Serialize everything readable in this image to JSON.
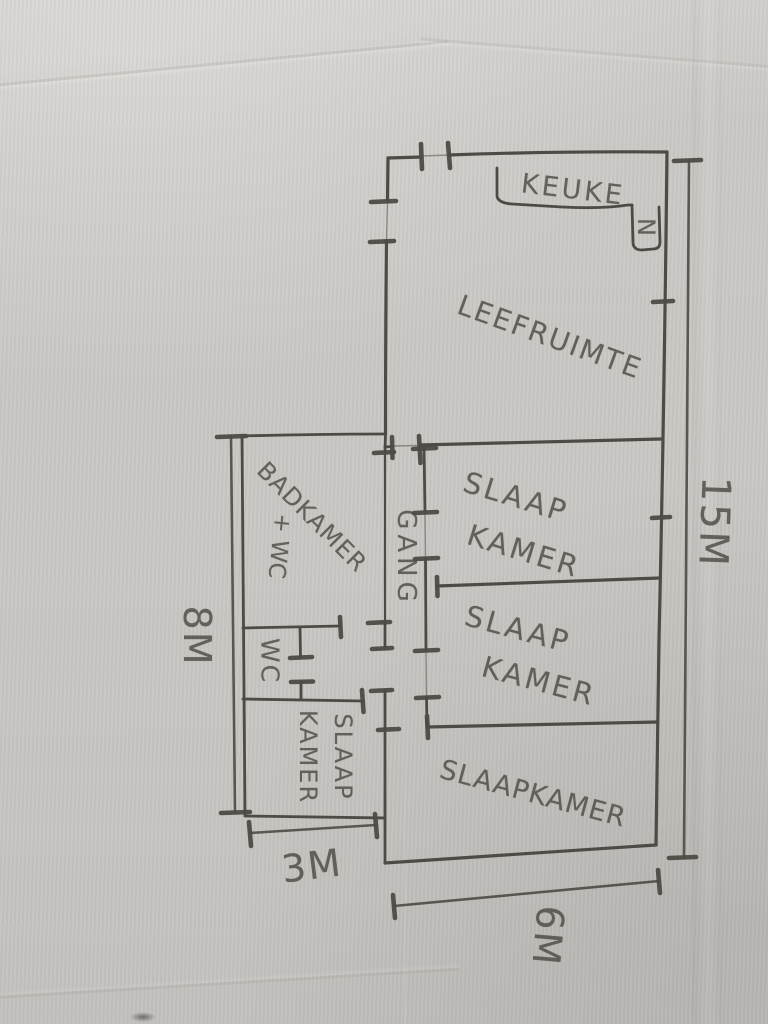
{
  "colors": {
    "pencil": "#4e4a45",
    "paper": "#c9c7c3"
  },
  "rooms": {
    "keuken": {
      "label_main": "KEUKE",
      "label_n": "N"
    },
    "leefruimte": {
      "label": "LEEFRUIMTE"
    },
    "slaapkamer_1": {
      "line1": "SLAAP",
      "line2": "KAMER"
    },
    "slaapkamer_2": {
      "line1": "SLAAP",
      "line2": "KAMER"
    },
    "slaapkamer_groot": {
      "label": "SLAAPKAMER"
    },
    "slaapkamer_annex": {
      "line1": "SLAAP",
      "line2": "KAMER"
    },
    "badkamer": {
      "line1": "BADKAMER",
      "line2": "+ WC"
    },
    "wc": {
      "label": "WC"
    },
    "gang": {
      "label": "GANG"
    }
  },
  "dimensions": {
    "right": {
      "label": "15M"
    },
    "left": {
      "label": "8M"
    },
    "bottom_left": {
      "label": "3M"
    },
    "bottom_right": {
      "label": "6M"
    }
  }
}
